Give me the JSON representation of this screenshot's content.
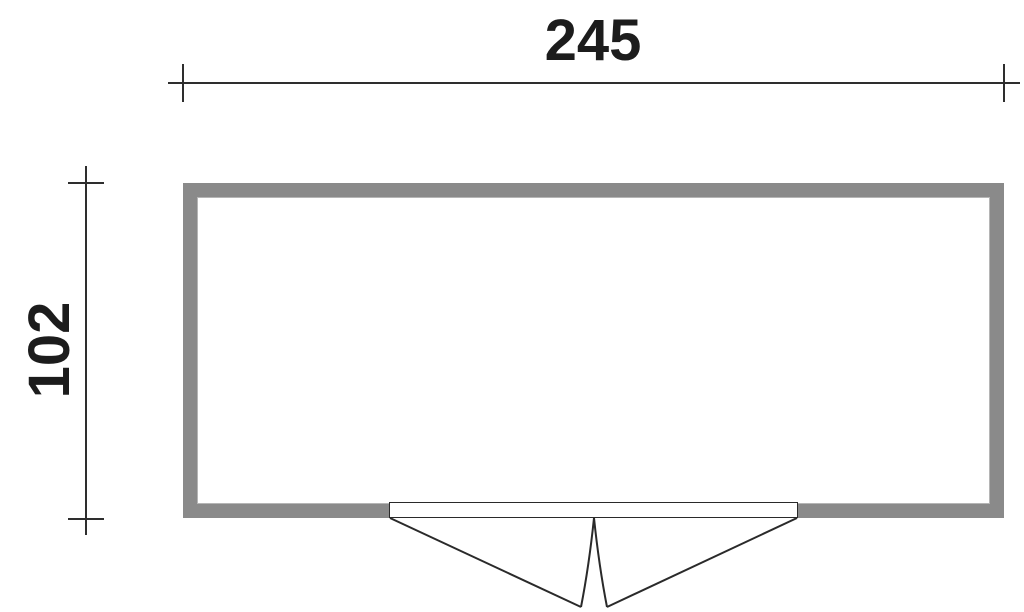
{
  "drawing": {
    "type": "floor-plan",
    "width_label": "245",
    "height_label": "102"
  },
  "colors": {
    "background": "#ffffff",
    "wall-fill": "#8a8a8a",
    "wall-inner-edge": "#b5b5b5",
    "dimension-line": "#2e2e2e",
    "door-line": "#2a2a2a",
    "label-text": "#1c1c1c"
  }
}
